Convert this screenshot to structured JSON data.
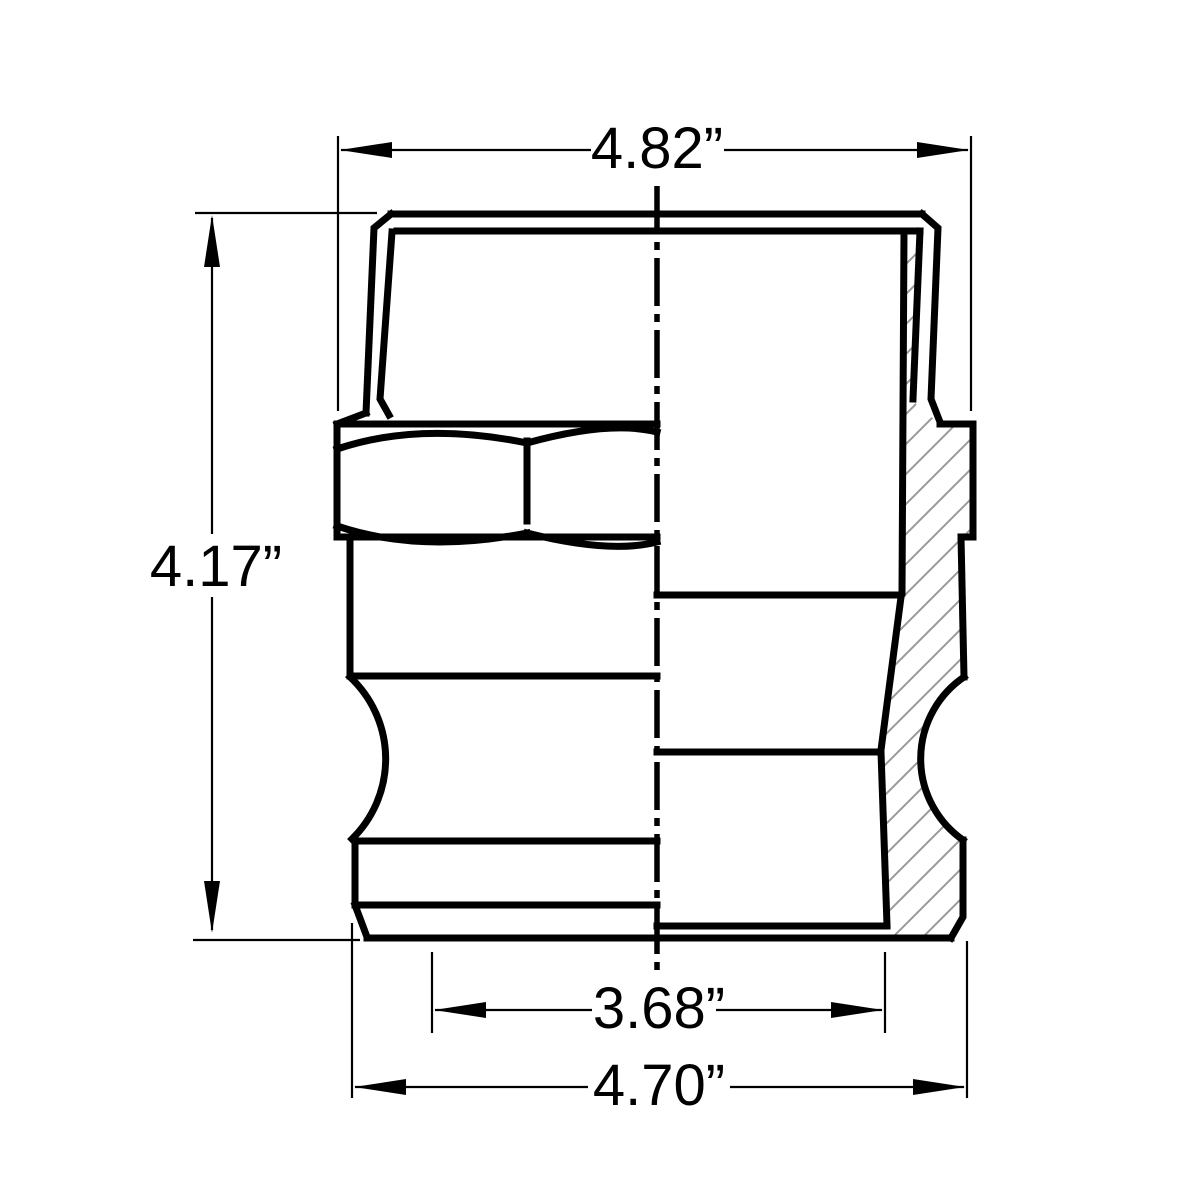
{
  "drawing": {
    "title": "camlock-male-adapter-half-section",
    "type": "technical-dimension-drawing",
    "units": "inches",
    "background_color": "#ffffff",
    "line_color": "#000000",
    "hatch_color": "#999999",
    "dimensions": {
      "top_width": "4.82”",
      "overall_height": "4.17”",
      "inner_bottom_width": "3.68”",
      "bottom_width": "4.70”"
    }
  }
}
